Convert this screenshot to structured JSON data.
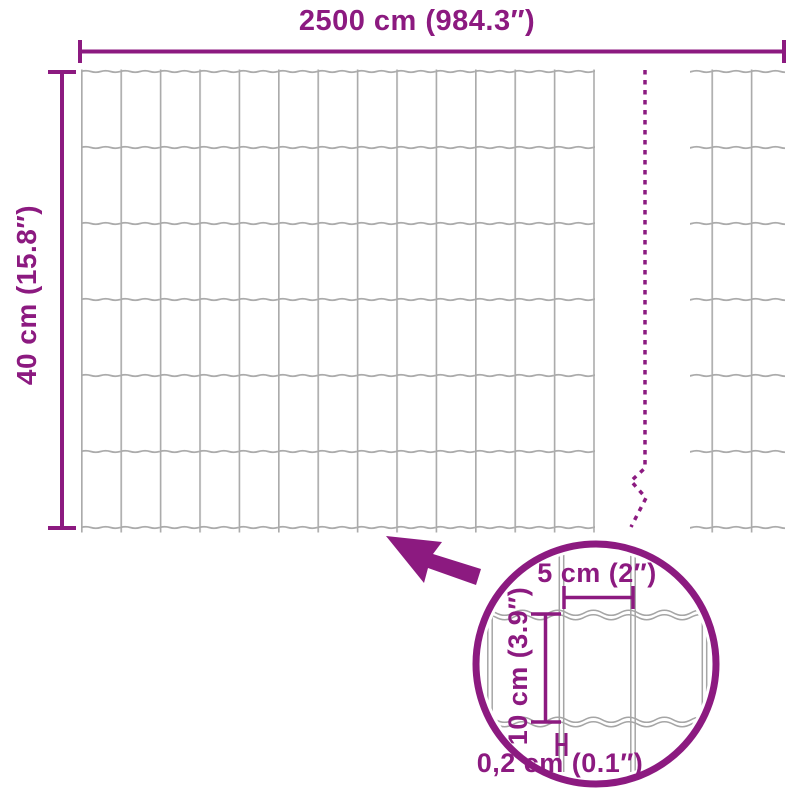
{
  "diagram": {
    "name": "wire-mesh-fence-dimension-diagram",
    "colors": {
      "accent": "#8C1A80",
      "wire": "#ABABAB",
      "wire_detail": "#A5A5A5",
      "background": "#FFFFFF"
    },
    "dimensions": {
      "total_width_label": "2500 cm (984.3″)",
      "roll_height_label": "40 cm (15.8″)"
    },
    "detail": {
      "mesh_width_label": "5 cm (2″)",
      "mesh_height_label": "10 cm (3.9″)",
      "wire_thickness_label": "0,2 cm (0.1″)"
    }
  }
}
